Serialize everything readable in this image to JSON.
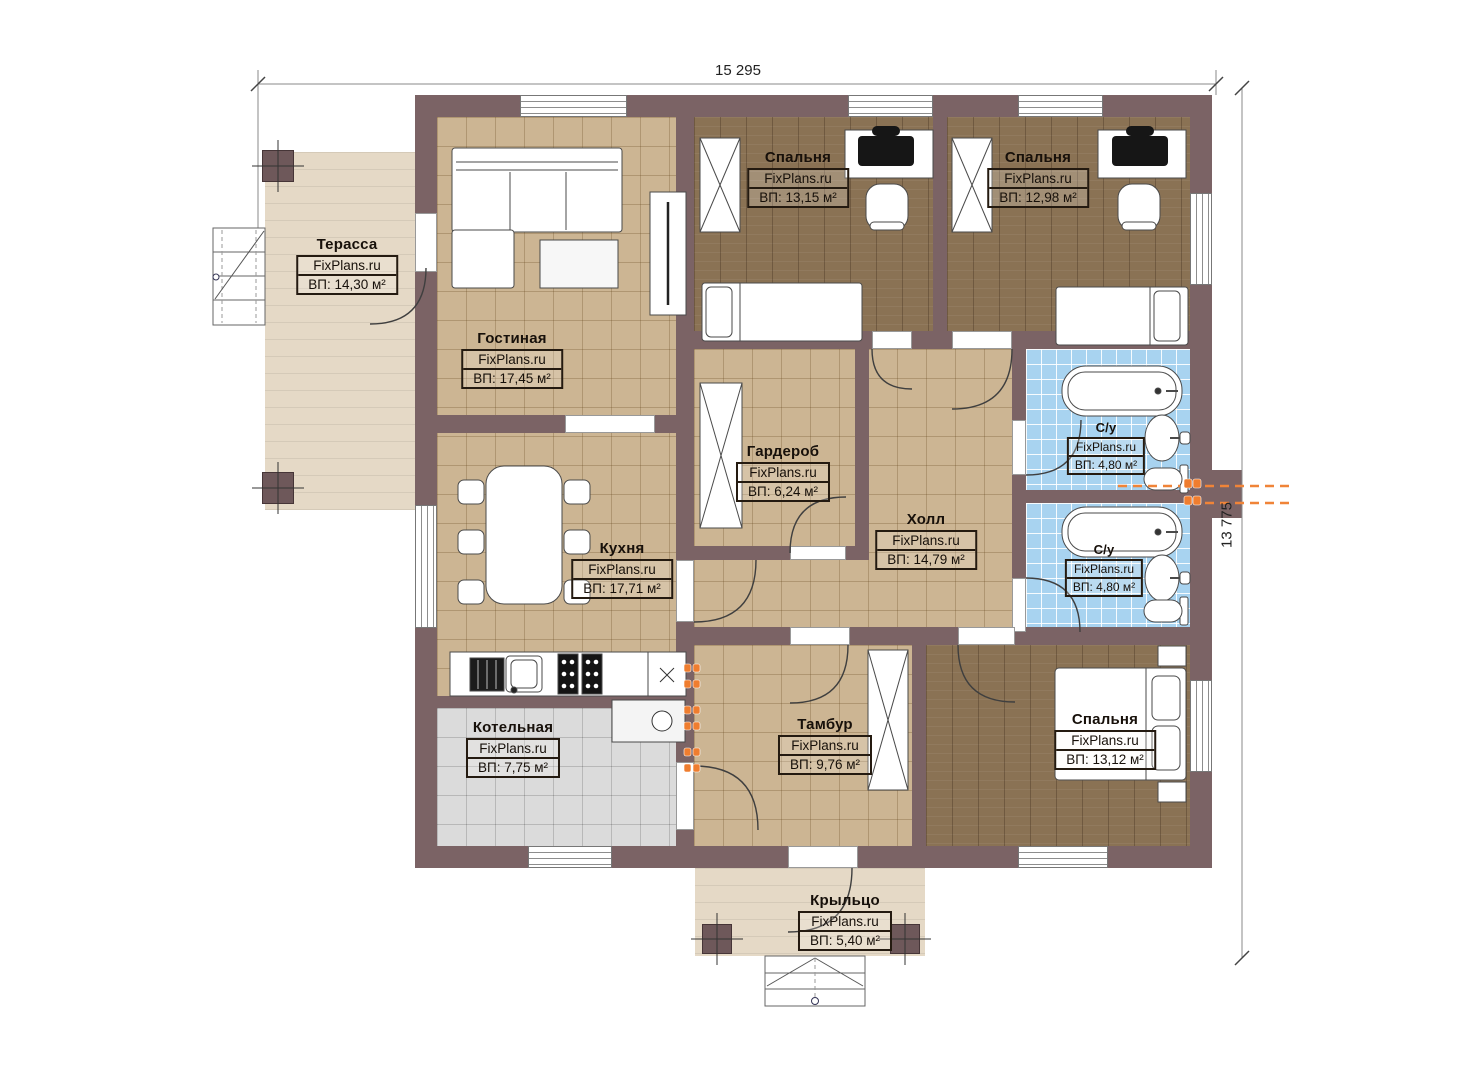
{
  "dimensions": {
    "width_label": "15 295",
    "height_label": "13 775"
  },
  "watermark": "FixPlans.ru",
  "colors": {
    "wall": "#7b6365",
    "floor_tile_tan": "#ccb593",
    "floor_wood_brown": "#8a7254",
    "floor_bath_blue": "#a8d3f0",
    "floor_boiler_gray": "#dbdbdb",
    "floor_terrace_beige": "#e5d9c6",
    "radiator_orange": "#ef7d2f"
  },
  "rooms": [
    {
      "id": "terrace",
      "name": "Терасса",
      "wm": "FixPlans.ru",
      "area": "ВП: 14,30 м²"
    },
    {
      "id": "living",
      "name": "Гостиная",
      "wm": "FixPlans.ru",
      "area": "ВП: 17,45 м²"
    },
    {
      "id": "bedroom1",
      "name": "Спальня",
      "wm": "FixPlans.ru",
      "area": "ВП: 13,15 м²"
    },
    {
      "id": "bedroom2",
      "name": "Спальня",
      "wm": "FixPlans.ru",
      "area": "ВП: 12,98 м²"
    },
    {
      "id": "wardrobe",
      "name": "Гардероб",
      "wm": "FixPlans.ru",
      "area": "ВП: 6,24 м²"
    },
    {
      "id": "hall",
      "name": "Холл",
      "wm": "FixPlans.ru",
      "area": "ВП: 14,79 м²"
    },
    {
      "id": "bath1",
      "name": "С/у",
      "wm": "FixPlans.ru",
      "area": "ВП: 4,80 м²"
    },
    {
      "id": "bath2",
      "name": "С/у",
      "wm": "FixPlans.ru",
      "area": "ВП: 4,80 м²"
    },
    {
      "id": "kitchen",
      "name": "Кухня",
      "wm": "FixPlans.ru",
      "area": "ВП: 17,71 м²"
    },
    {
      "id": "boiler",
      "name": "Котельная",
      "wm": "FixPlans.ru",
      "area": "ВП: 7,75 м²"
    },
    {
      "id": "vestibule",
      "name": "Тамбур",
      "wm": "FixPlans.ru",
      "area": "ВП: 9,76 м²"
    },
    {
      "id": "bedroom3",
      "name": "Спальня",
      "wm": "FixPlans.ru",
      "area": "ВП: 13,12 м²"
    },
    {
      "id": "porch",
      "name": "Крыльцо",
      "wm": "FixPlans.ru",
      "area": "ВП: 5,40 м²"
    }
  ]
}
